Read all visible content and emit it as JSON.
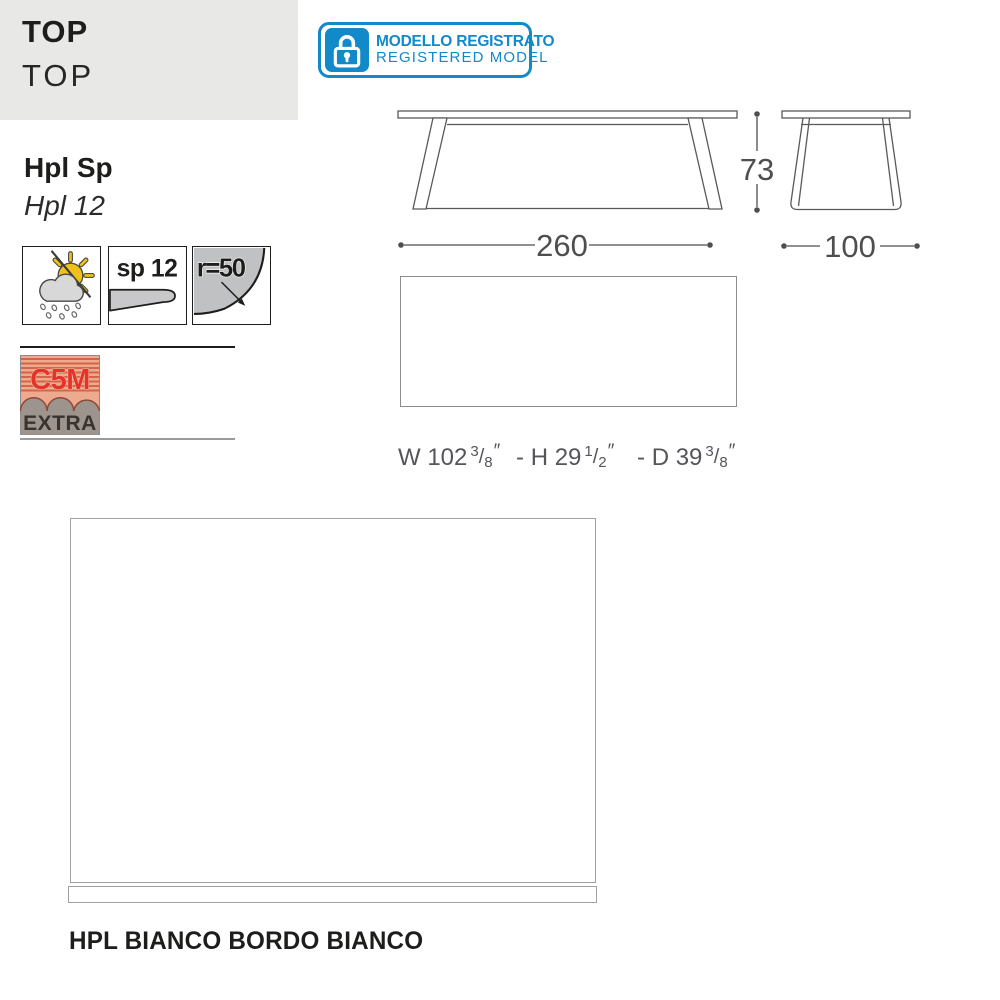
{
  "header": {
    "title": "TOP",
    "subtitle": "TOP"
  },
  "registered": {
    "icon": "lock-icon",
    "line1": "MODELLO REGISTRATO",
    "line2": "REGISTERED MODEL",
    "accent_color": "#1289c8"
  },
  "material": {
    "name": "Hpl Sp",
    "variant": "Hpl 12"
  },
  "spec_icons": {
    "weather": "sun-cloud-rain-outdoor-icon",
    "thickness_label": "sp 12",
    "radius_label": "r=50"
  },
  "certification": {
    "class": "C5M",
    "grade": "EXTRA",
    "red": "#e5332a",
    "salmon": "#edaa8e",
    "gray": "#9c948d"
  },
  "dimensions": {
    "width_cm": "260",
    "height_cm": "73",
    "depth_cm": "100"
  },
  "imperial": {
    "w_prefix": "W 102",
    "w_num": "3",
    "w_den": "8",
    "h_prefix": "- H 29",
    "h_num": "1",
    "h_den": "2",
    "d_prefix": "- D 39",
    "d_num": "3",
    "d_den": "8",
    "inch": "″",
    "slash": "/"
  },
  "finish": {
    "caption": "HPL BIANCO BORDO BIANCO"
  },
  "colors": {
    "drawing_line": "#58595b",
    "header_bg": "#e8e8e6"
  }
}
